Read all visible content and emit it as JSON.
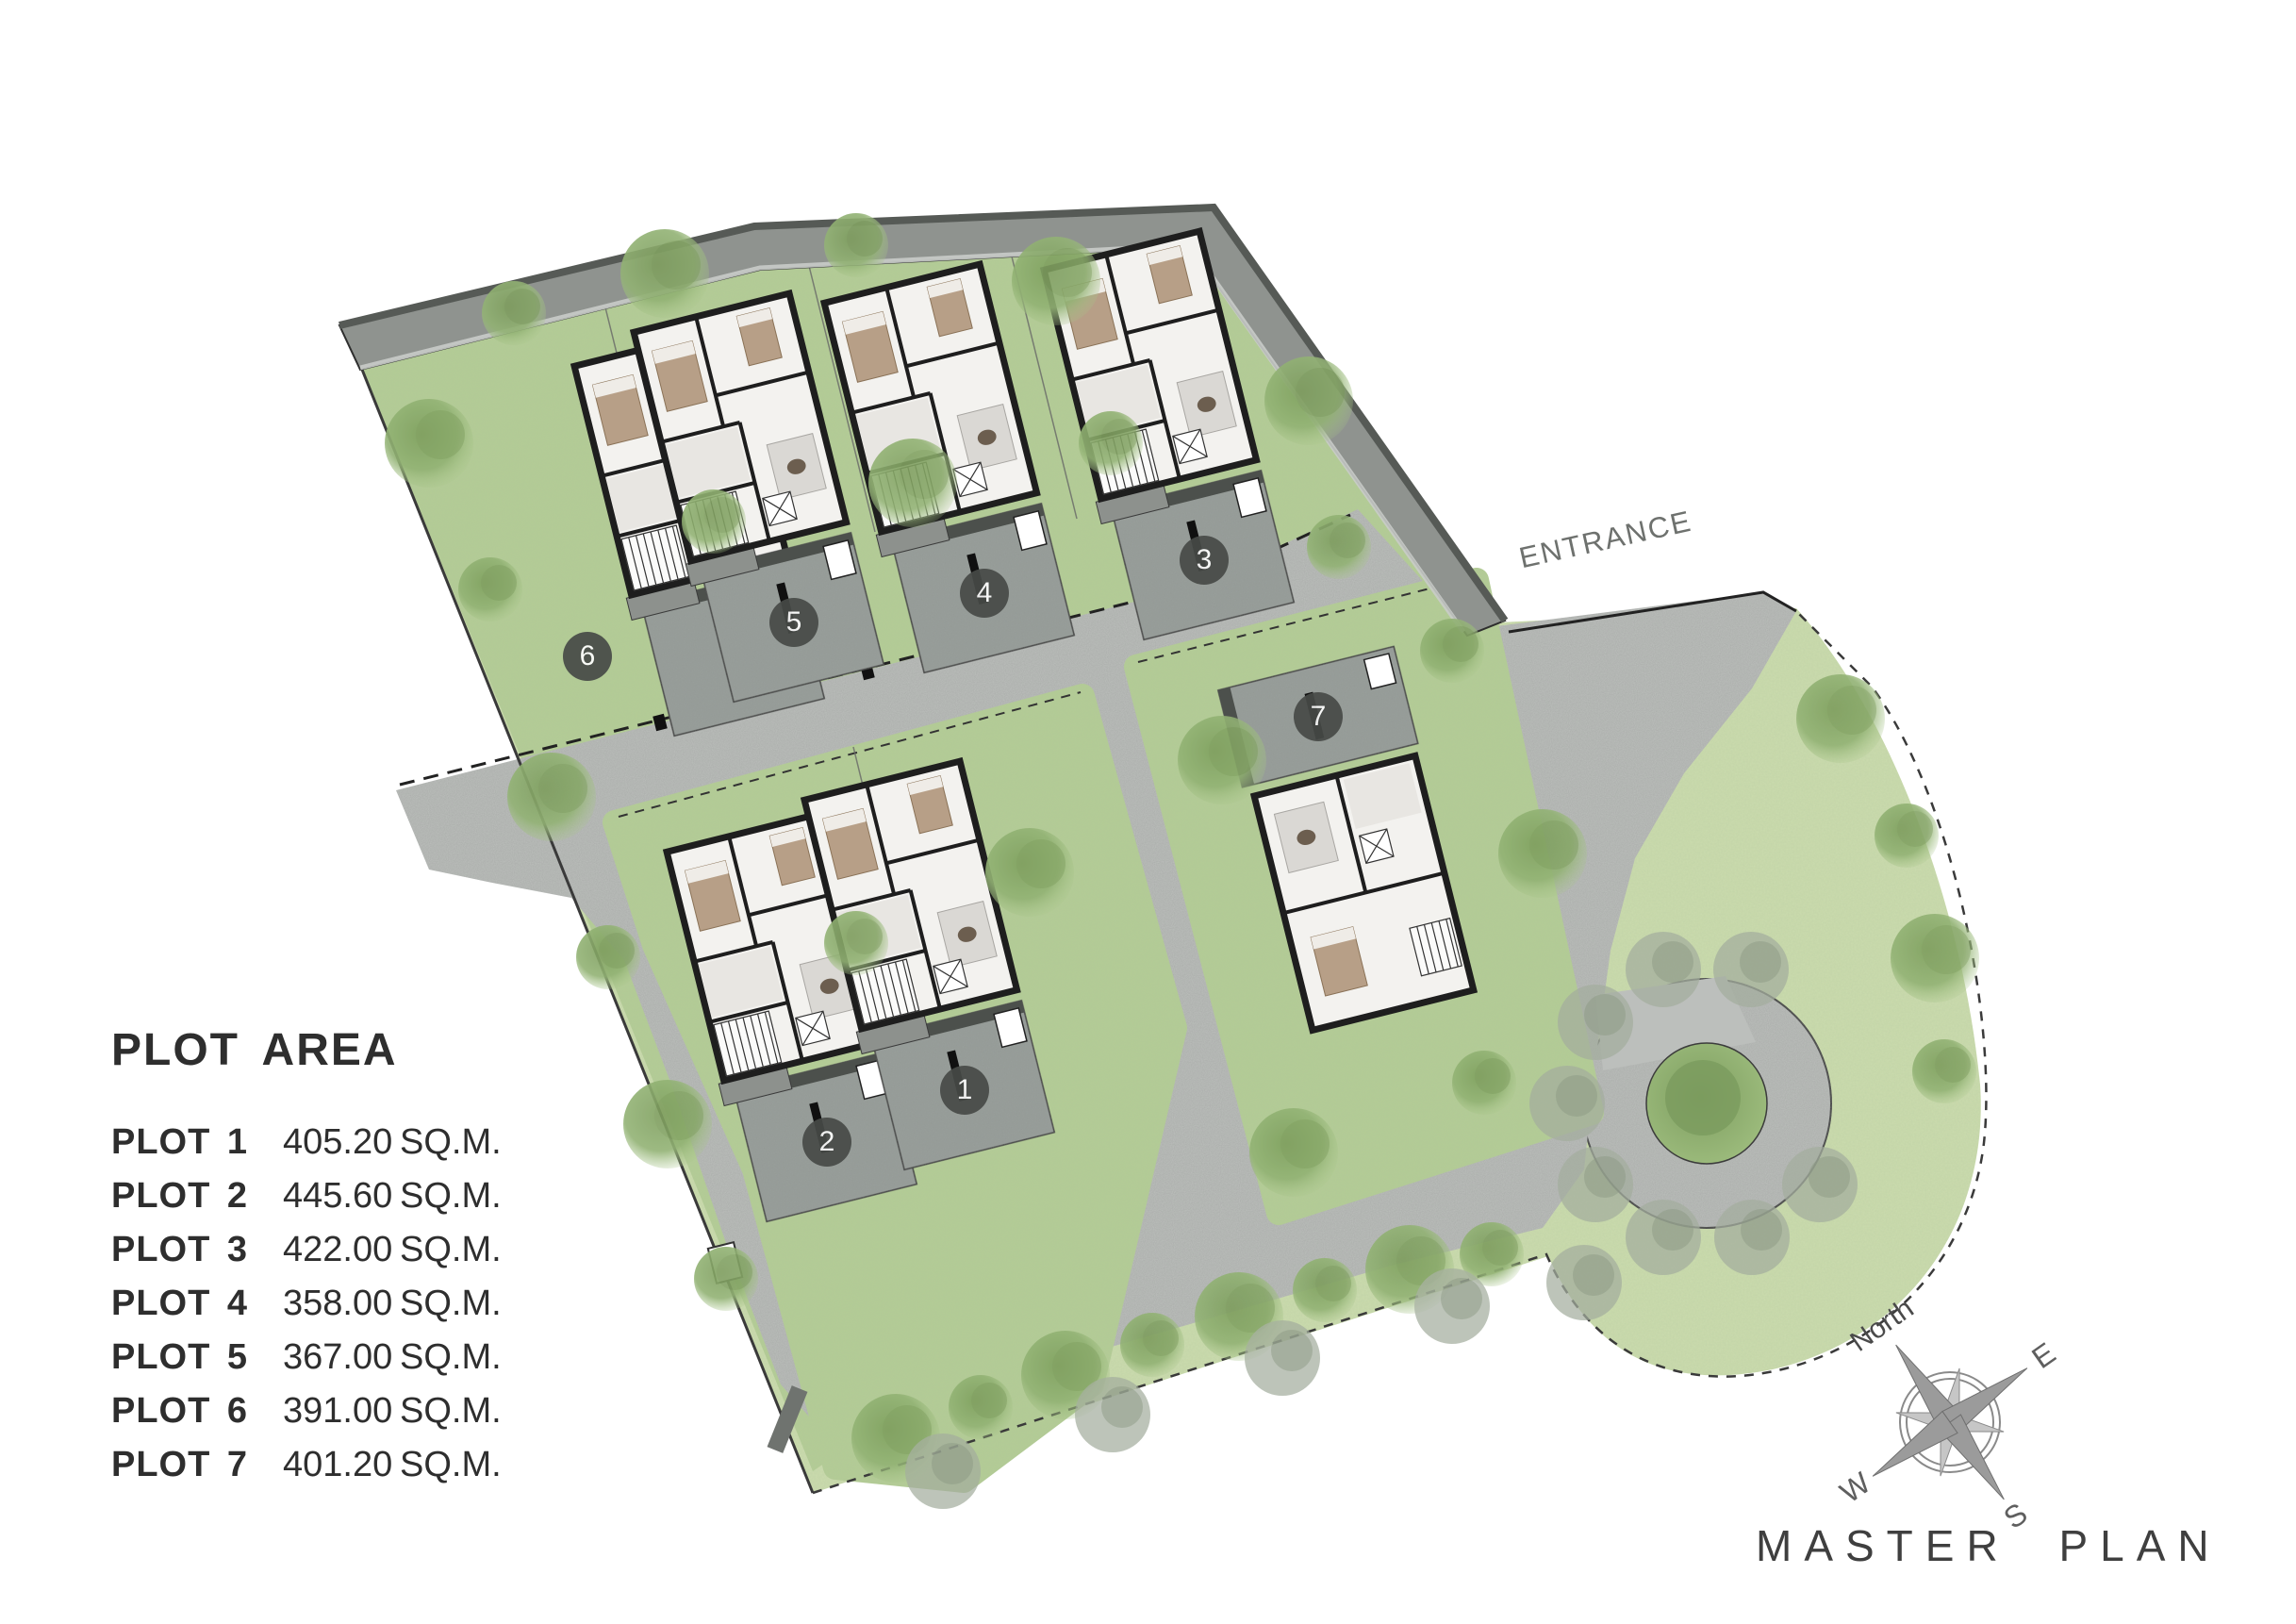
{
  "title": "MASTER PLAN",
  "entrance_label": "ENTRANCE",
  "legend": {
    "title": "PLOT AREA"
  },
  "plots": [
    {
      "number": "1",
      "label": "PLOT 1",
      "area": "405.20",
      "unit": "SQ.M."
    },
    {
      "number": "2",
      "label": "PLOT 2",
      "area": "445.60",
      "unit": "SQ.M."
    },
    {
      "number": "3",
      "label": "PLOT 3",
      "area": "422.00",
      "unit": "SQ.M."
    },
    {
      "number": "4",
      "label": "PLOT 4",
      "area": "358.00",
      "unit": "SQ.M."
    },
    {
      "number": "5",
      "label": "PLOT 5",
      "area": "367.00",
      "unit": "SQ.M."
    },
    {
      "number": "6",
      "label": "PLOT 6",
      "area": "391.00",
      "unit": "SQ.M."
    },
    {
      "number": "7",
      "label": "PLOT 7",
      "area": "401.20",
      "unit": "SQ.M."
    }
  ],
  "compass": {
    "north": "North",
    "east": "E",
    "west": "W",
    "south": "S"
  },
  "colors": {
    "lawn": "#b3cc95",
    "lawn_light": "#cbdcae",
    "road": "#bcbfbc",
    "driveway": "#9aa09c",
    "wall_band": "#8f938f",
    "marker_bg": "#474a47",
    "text_dark": "#2e2e2e",
    "text_gray": "#6e716e"
  }
}
